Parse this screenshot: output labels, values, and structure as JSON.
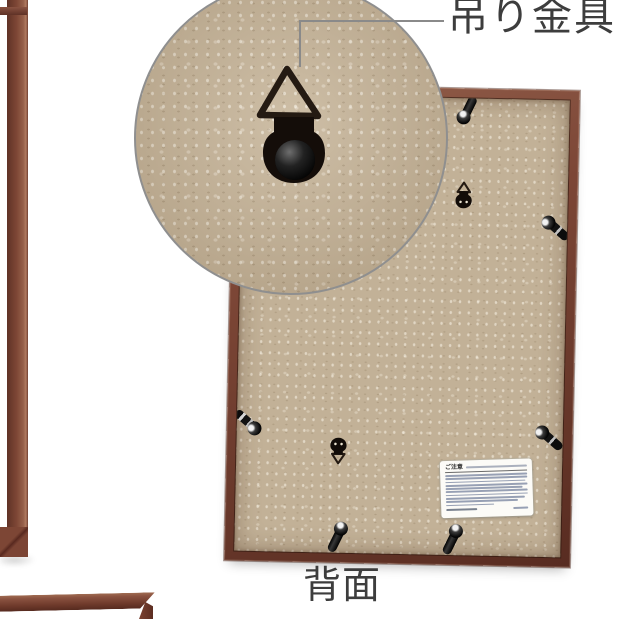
{
  "photo": {
    "type": "product-photo-back-of-picture-frame",
    "background": "#ffffff"
  },
  "annotation": {
    "label": "吊り金具",
    "line_color": "#8a8a8a",
    "text_color": "#3d3d3d"
  },
  "caption": {
    "text": "背面",
    "text_color": "#3d3d3d"
  },
  "sticker": {
    "title": "ご注意"
  },
  "frame": {
    "wood_color": "#7b4334",
    "backboard_color": "#c2b197",
    "hardware_color": "#16100b",
    "clip_count": 6,
    "d_ring_count": 2
  },
  "inset": {
    "subject": "d-ring-hanger-closeup",
    "border_color": "#8f8f8f"
  }
}
